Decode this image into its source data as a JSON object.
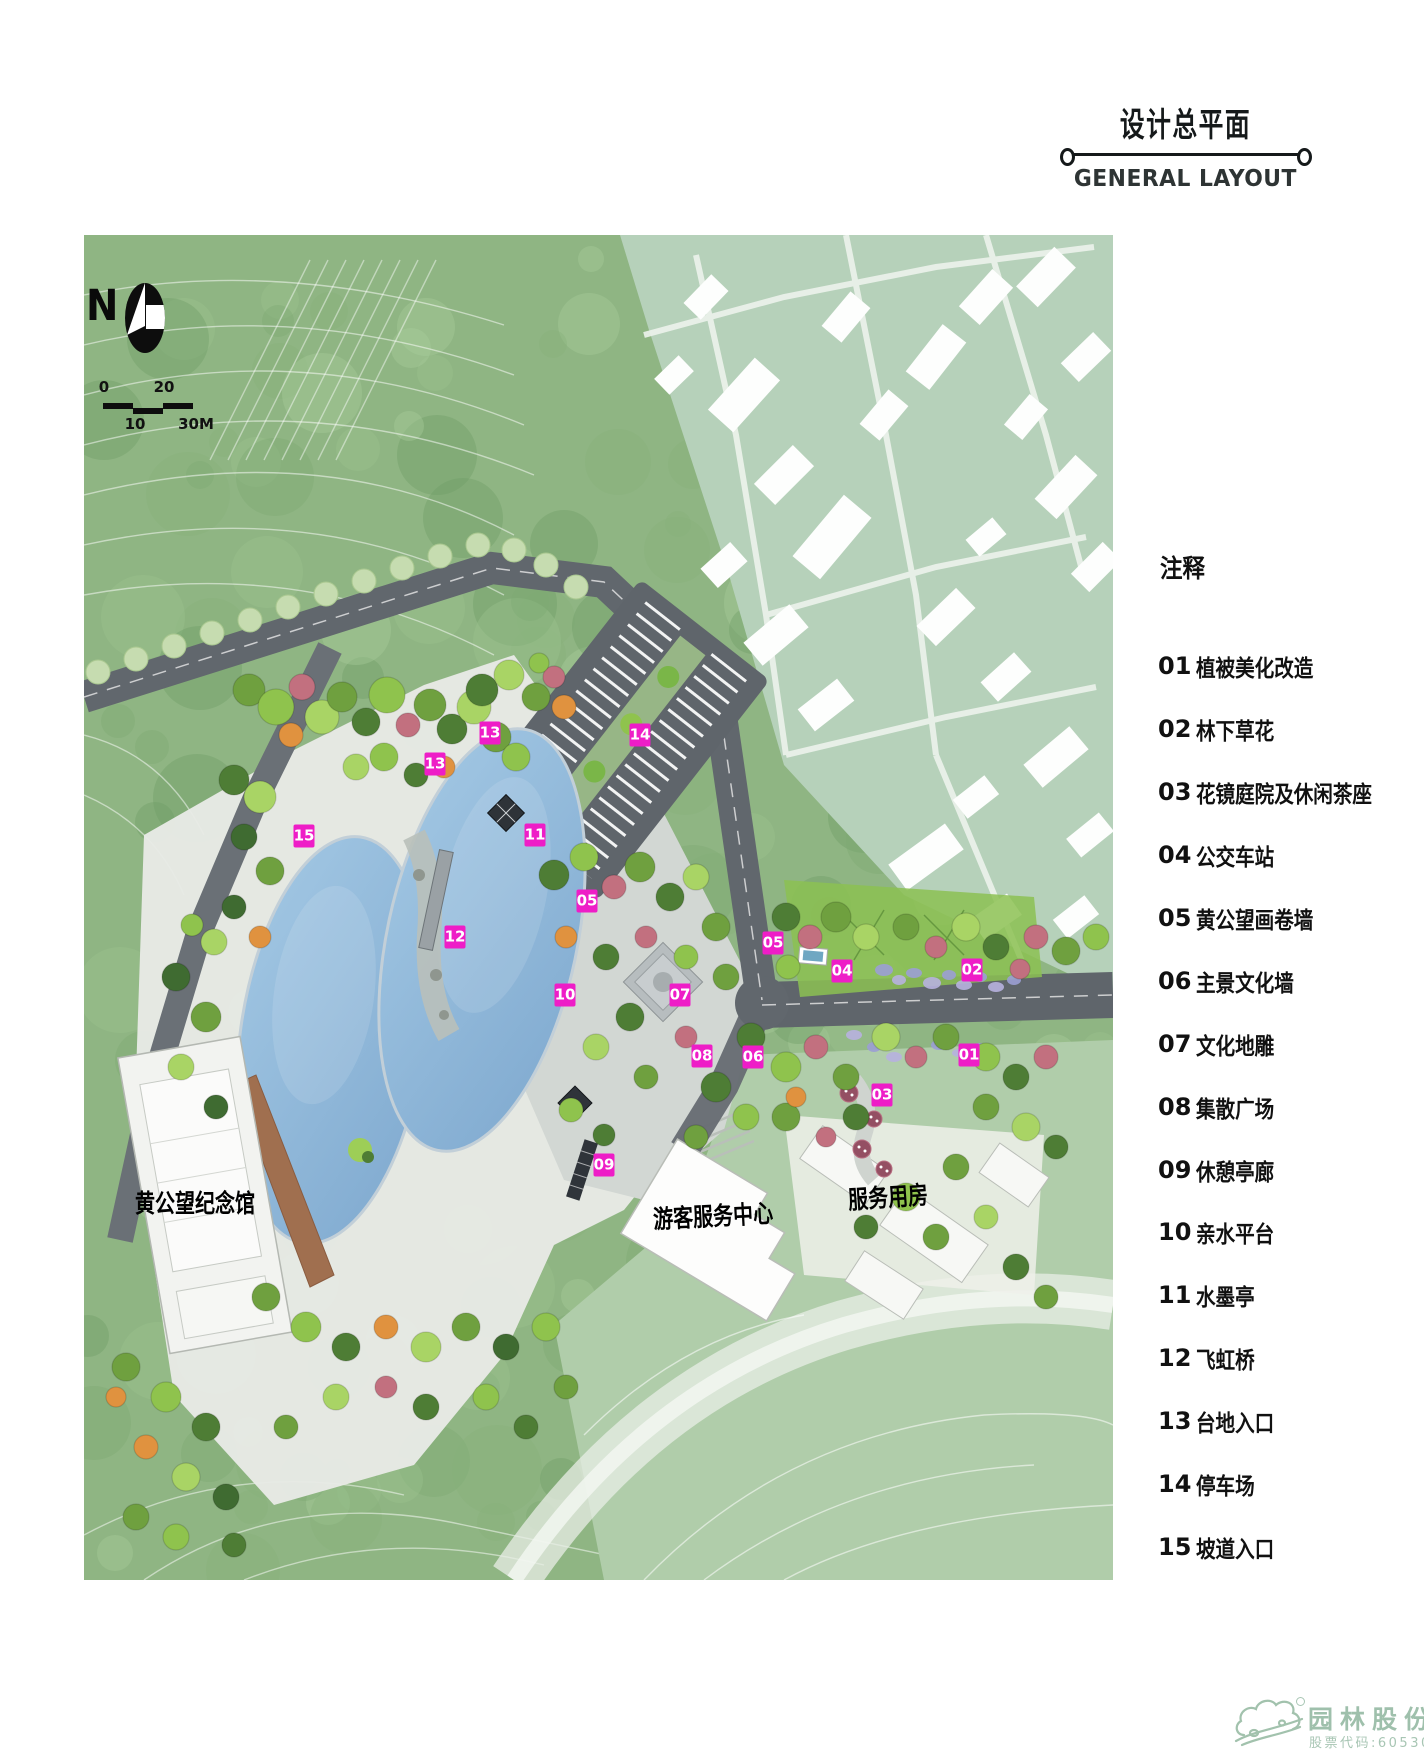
{
  "title": {
    "zh": "设计总平面",
    "en": "GENERAL LAYOUT"
  },
  "legend": {
    "header": "注释",
    "items": [
      {
        "num": "01",
        "label": "植被美化改造"
      },
      {
        "num": "02",
        "label": "林下草花"
      },
      {
        "num": "03",
        "label": "花镜庭院及休闲茶座"
      },
      {
        "num": "04",
        "label": "公交车站"
      },
      {
        "num": "05",
        "label": "黄公望画卷墙"
      },
      {
        "num": "06",
        "label": "主景文化墙"
      },
      {
        "num": "07",
        "label": "文化地雕"
      },
      {
        "num": "08",
        "label": "集散广场"
      },
      {
        "num": "09",
        "label": "休憩亭廊"
      },
      {
        "num": "10",
        "label": "亲水平台"
      },
      {
        "num": "11",
        "label": "水墨亭"
      },
      {
        "num": "12",
        "label": "飞虹桥"
      },
      {
        "num": "13",
        "label": "台地入口"
      },
      {
        "num": "14",
        "label": "停车场"
      },
      {
        "num": "15",
        "label": "坡道入口"
      }
    ]
  },
  "map": {
    "north_label": "N",
    "scale": {
      "zero": "0",
      "twenty": "20",
      "ten": "10",
      "thirty": "30M"
    },
    "labels": {
      "memorial": "黄公望纪念馆",
      "visitor_center": "游客服务中心",
      "service_building": "服务用房"
    },
    "markers": [
      {
        "num": "13",
        "x": 406,
        "y": 498
      },
      {
        "num": "14",
        "x": 556,
        "y": 500
      },
      {
        "num": "13",
        "x": 351,
        "y": 529
      },
      {
        "num": "15",
        "x": 220,
        "y": 601
      },
      {
        "num": "11",
        "x": 451,
        "y": 600
      },
      {
        "num": "05",
        "x": 503,
        "y": 666
      },
      {
        "num": "12",
        "x": 371,
        "y": 702
      },
      {
        "num": "05",
        "x": 689,
        "y": 708
      },
      {
        "num": "04",
        "x": 758,
        "y": 736
      },
      {
        "num": "02",
        "x": 888,
        "y": 735
      },
      {
        "num": "10",
        "x": 481,
        "y": 760
      },
      {
        "num": "07",
        "x": 596,
        "y": 760
      },
      {
        "num": "08",
        "x": 618,
        "y": 821
      },
      {
        "num": "06",
        "x": 669,
        "y": 822
      },
      {
        "num": "01",
        "x": 885,
        "y": 820
      },
      {
        "num": "03",
        "x": 798,
        "y": 860
      },
      {
        "num": "09",
        "x": 520,
        "y": 930
      }
    ]
  },
  "logo": {
    "name": "园林股份",
    "stock": "股票代码:605303"
  },
  "colors": {
    "marker_magenta": "#ee1dc7",
    "road_gray": "#61676d",
    "lake_blue": "#8fb7da",
    "forest_green": "#8fb583",
    "village_green": "#b6d1ba",
    "logo_green": "#9fc0ac"
  }
}
